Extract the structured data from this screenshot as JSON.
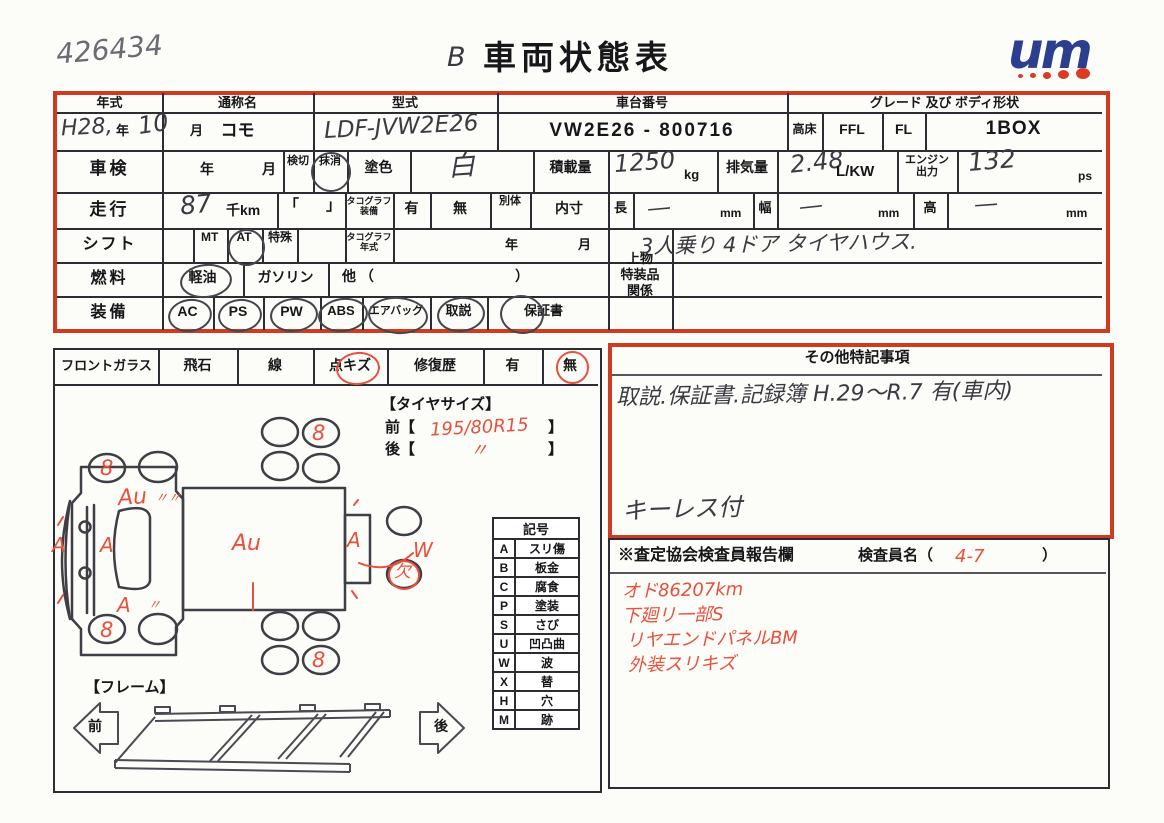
{
  "header": {
    "doc_number": "426434",
    "title_prefix": "B",
    "title": "車両状態表",
    "logo_text": "um"
  },
  "colors": {
    "box_red": "#cf3a20",
    "pen_red": "#e8503c",
    "pen_dark": "#3a3a42",
    "logo_blue": "#2b3f8e",
    "logo_dot_red": "#d93b24"
  },
  "spec": {
    "row1": {
      "year_label": "年式",
      "year_era": "H28,",
      "year_unit": "年",
      "month_value": "10",
      "month_unit": "月",
      "name_label": "通称名",
      "name_value": "コモ",
      "model_label": "型式",
      "model_value": "LDF-JVW2E26",
      "chassis_label": "車台番号",
      "chassis_value": "VW2E26 - 800716",
      "grade_label": "グレード 及び ボディ形状",
      "grade_takadoko": "高床",
      "grade_ffl": "FFL",
      "grade_fl": "FL",
      "grade_body": "1BOX"
    },
    "row2": {
      "label": "車検",
      "year_unit": "年",
      "month_unit": "月",
      "kengiri": "検切",
      "masshou": "抹消",
      "paint_label": "塗色",
      "paint_value": "白",
      "load_label": "積載量",
      "load_value": "1250",
      "load_unit": "kg",
      "disp_label": "排気量",
      "disp_value": "2.48",
      "disp_unit": "L/KW",
      "engine_label": "エンジン出力",
      "engine_value": "132",
      "engine_unit": "ps"
    },
    "row3": {
      "label": "走行",
      "value": "87",
      "unit": "千km",
      "bracket_open": "「",
      "bracket_close": "」",
      "tacho_label": "タコグラフ装備",
      "yes": "有",
      "no": "無",
      "bettai": "別体",
      "naisun": "内寸",
      "len_label": "長",
      "len_value": "―",
      "len_unit": "mm",
      "wid_label": "幅",
      "wid_value": "―",
      "wid_unit": "mm",
      "hgt_label": "高",
      "hgt_value": "―",
      "hgt_unit": "mm"
    },
    "row4": {
      "label": "シフト",
      "mt": "MT",
      "at": "AT",
      "tokushu": "特殊",
      "tacho_year_label": "タコグラフ年式",
      "year_unit": "年",
      "month_unit": "月"
    },
    "row5": {
      "label": "燃料",
      "keiyu": "軽油",
      "gasoline": "ガソリン",
      "other_open": "他 （",
      "other_close": "）"
    },
    "row6": {
      "label": "装備",
      "items": [
        "AC",
        "PS",
        "PW",
        "ABS",
        "エアバッグ",
        "取説",
        "保証書"
      ]
    },
    "uwamono": {
      "label_1": "上物",
      "label_2": "特装品",
      "label_3": "関係",
      "note": "3人乗り 4ドア タイヤハウス."
    }
  },
  "front_glass": {
    "label": "フロントガラス",
    "hiseki": "飛石",
    "sen": "線",
    "tenkizu": "点キズ",
    "shufuku": "修復歴",
    "yes": "有",
    "no": "無"
  },
  "tokki": {
    "header": "その他特記事項",
    "line1": "取説.保証書.記録簿 H.29〜R.7 有(車内)",
    "line2": "キーレス付"
  },
  "report": {
    "header": "※査定協会検査員報告欄",
    "inspector_label": "検査員名（",
    "inspector_value": "4-7",
    "inspector_close": "）",
    "notes": [
      "オド86207km",
      "下廻リ一部S",
      "リヤエンドパネルBM",
      "外装スリキズ"
    ]
  },
  "tire": {
    "header": "【タイヤサイズ】",
    "front_label": "前【",
    "front_value": "195/80R15",
    "front_close": "】",
    "rear_label": "後【",
    "rear_value": "〃",
    "rear_close": "】"
  },
  "legend": {
    "header": "記号",
    "rows": [
      {
        "code": "A",
        "label": "スリ傷"
      },
      {
        "code": "B",
        "label": "板金"
      },
      {
        "code": "C",
        "label": "腐食"
      },
      {
        "code": "P",
        "label": "塗装"
      },
      {
        "code": "S",
        "label": "さび"
      },
      {
        "code": "U",
        "label": "凹凸曲"
      },
      {
        "code": "W",
        "label": "波"
      },
      {
        "code": "X",
        "label": "替"
      },
      {
        "code": "H",
        "label": "穴"
      },
      {
        "code": "M",
        "label": "跡"
      }
    ]
  },
  "frame": {
    "header": "【フレーム】",
    "front_arrow": "前",
    "rear_arrow": "後"
  },
  "diagram": {
    "wheel_mark_fl": "8",
    "wheel_mark_tr": "8",
    "wheel_mark_bl": "8",
    "wheel_mark_br": "8",
    "cab_mark": "Au",
    "cab_ditto": "〃〃",
    "bumper_mark": "A",
    "cab_center_mark": "A",
    "cab_bottom_mark": "A",
    "cab_bottom_ditto": "〃",
    "body_mark": "Au",
    "rear_mark": "A",
    "wave_mark": "W",
    "missing_mark": "欠"
  }
}
